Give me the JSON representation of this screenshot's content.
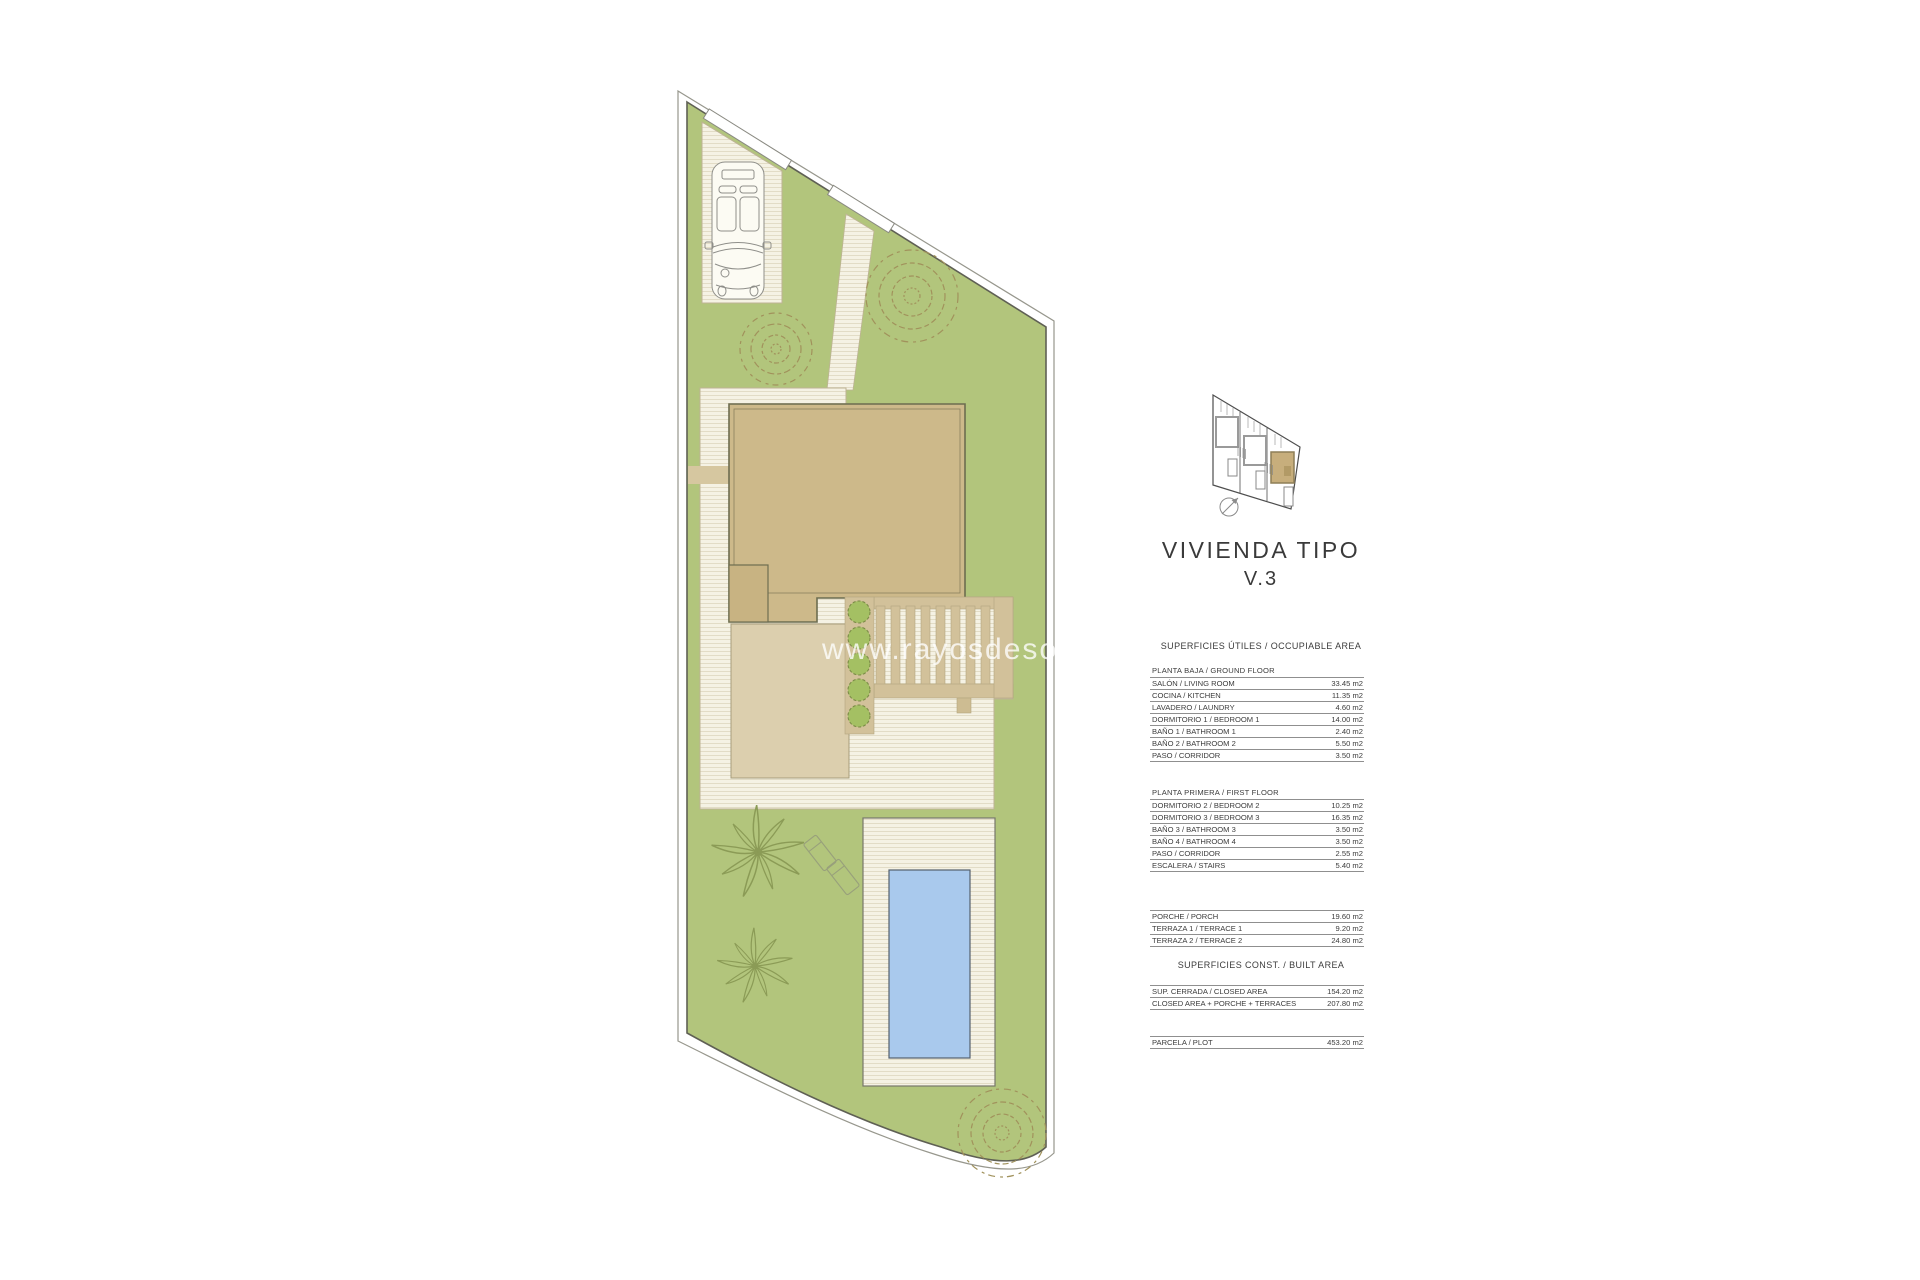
{
  "watermark": "www.rayosdesol.be",
  "title": {
    "line1": "VIVIENDA TIPO",
    "line2": "V.3"
  },
  "colors": {
    "garden": "#b2c57c",
    "house": "#cdb98a",
    "pool": "#a9c9ed",
    "highlight": "#c7ae7c"
  },
  "tables": {
    "occupiable": {
      "heading": "SUPERFICIES ÚTILES / OCCUPIABLE AREA",
      "groups": [
        {
          "title": "PLANTA BAJA / GROUND FLOOR",
          "rows": [
            {
              "label": "SALÓN / LIVING ROOM",
              "value": "33.45 m2"
            },
            {
              "label": "COCINA / KITCHEN",
              "value": "11.35 m2"
            },
            {
              "label": "LAVADERO / LAUNDRY",
              "value": "4.60 m2"
            },
            {
              "label": "DORMITORIO 1 /  BEDROOM 1",
              "value": "14.00 m2"
            },
            {
              "label": "BAÑO 1 / BATHROOM 1",
              "value": "2.40 m2"
            },
            {
              "label": "BAÑO 2 / BATHROOM 2",
              "value": "5.50 m2"
            },
            {
              "label": "PASO / CORRIDOR",
              "value": "3.50 m2"
            }
          ]
        },
        {
          "title": "PLANTA PRIMERA / FIRST FLOOR",
          "rows": [
            {
              "label": "DORMITORIO 2 / BEDROOM 2",
              "value": "10.25 m2"
            },
            {
              "label": "DORMITORIO 3 / BEDROOM 3",
              "value": "16.35 m2"
            },
            {
              "label": "BAÑO 3 / BATHROOM 3",
              "value": "3.50 m2"
            },
            {
              "label": "BAÑO 4 / BATHROOM 4",
              "value": "3.50 m2"
            },
            {
              "label": "PASO / CORRIDOR",
              "value": "2.55 m2"
            },
            {
              "label": "ESCALERA / STAIRS",
              "value": "5.40 m2"
            }
          ]
        },
        {
          "title": "",
          "rows": [
            {
              "label": "PORCHE / PORCH",
              "value": "19.60 m2"
            },
            {
              "label": "TERRAZA 1 / TERRACE 1",
              "value": "9.20 m2"
            },
            {
              "label": "TERRAZA 2 / TERRACE 2",
              "value": "24.80 m2"
            }
          ]
        }
      ]
    },
    "built": {
      "heading": "SUPERFICIES CONST. / BUILT AREA",
      "groups": [
        {
          "title": "",
          "rows": [
            {
              "label": "SUP. CERRADA / CLOSED AREA",
              "value": "154.20 m2"
            },
            {
              "label": "CLOSED AREA + PORCHE + TERRACES",
              "value": "207.80 m2"
            }
          ]
        },
        {
          "title": "",
          "rows": [
            {
              "label": "PARCELA / PLOT",
              "value": "453.20 m2"
            }
          ]
        }
      ]
    }
  }
}
